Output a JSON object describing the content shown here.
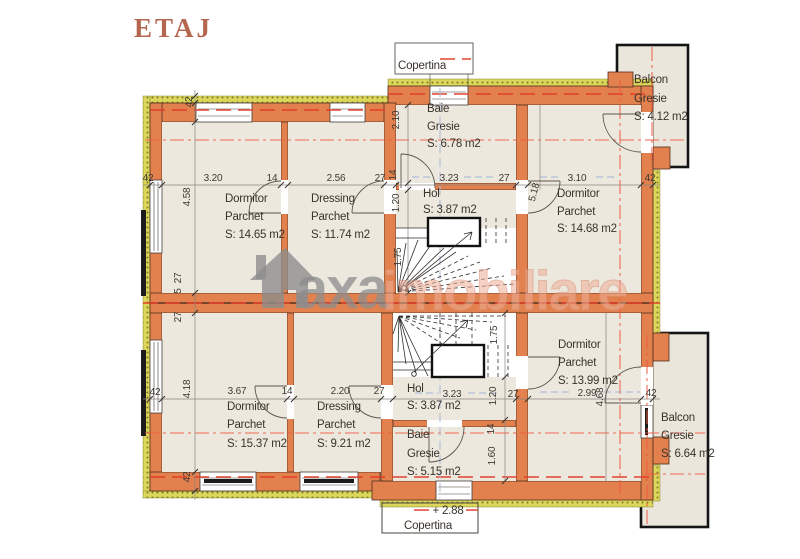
{
  "title": "ETAJ",
  "watermark": {
    "icon": "house-icon",
    "brand": "axa",
    "brand_suffix": "imobiliare"
  },
  "labels": {
    "copertina_top": "Copertina",
    "copertina_bottom": "Copertina",
    "level": "+ 2.88"
  },
  "rooms": [
    {
      "id": "dormitor-1",
      "name": "Dormitor",
      "finish": "Parchet",
      "area": "S: 14.65 m2"
    },
    {
      "id": "dressing-1",
      "name": "Dressing",
      "finish": "Parchet",
      "area": "S: 11.74 m2"
    },
    {
      "id": "baie-1",
      "name": "Baie",
      "finish": "Gresie",
      "area": "S: 6.78 m2"
    },
    {
      "id": "hol-1",
      "name": "Hol",
      "area": "S: 3.87 m2"
    },
    {
      "id": "dormitor-2",
      "name": "Dormitor",
      "finish": "Parchet",
      "area": "S: 14.68 m2"
    },
    {
      "id": "balcon-1",
      "name": "Balcon",
      "finish": "Gresie",
      "area": "S: 4.12 m2"
    },
    {
      "id": "dormitor-3",
      "name": "Dormitor",
      "finish": "Parchet",
      "area": "S: 15.37 m2"
    },
    {
      "id": "dressing-2",
      "name": "Dressing",
      "finish": "Parchet",
      "area": "S: 9.21 m2"
    },
    {
      "id": "hol-2",
      "name": "Hol",
      "area": "S: 3.87 m2"
    },
    {
      "id": "baie-2",
      "name": "Baie",
      "finish": "Gresie",
      "area": "S: 5.15 m2"
    },
    {
      "id": "dormitor-4",
      "name": "Dormitor",
      "finish": "Parchet",
      "area": "S: 13.99 m2"
    },
    {
      "id": "balcon-2",
      "name": "Balcon",
      "finish": "Gresie",
      "area": "S: 6.64 m2"
    }
  ],
  "dims": {
    "top": [
      "3.20",
      "14",
      "2.56",
      "27",
      "3.23",
      "27",
      "3.10",
      "42"
    ],
    "bottom": [
      "3.67",
      "14",
      "2.20",
      "27",
      "3.23",
      "27",
      "2.99",
      "42"
    ],
    "left": [
      "42",
      "4.58",
      "27",
      "5",
      "27",
      "4.18",
      "42"
    ],
    "inner_top": [
      "2.10",
      "14",
      "1.20",
      "1.75",
      "5.18"
    ],
    "inner_bottom": [
      "1.75",
      "1.20",
      "14",
      "1.60",
      "4.68"
    ],
    "wall": [
      "42",
      "42"
    ]
  },
  "colors": {
    "wall": "#e2814e",
    "insulation": "#d9d44f",
    "floor": "#ede8de",
    "axis_red": "#ee5a42",
    "axis_blue": "#a9bad8",
    "title": "#b4674e",
    "watermark_gray": "#8d8d8d",
    "watermark_salmon": "#edae96"
  }
}
